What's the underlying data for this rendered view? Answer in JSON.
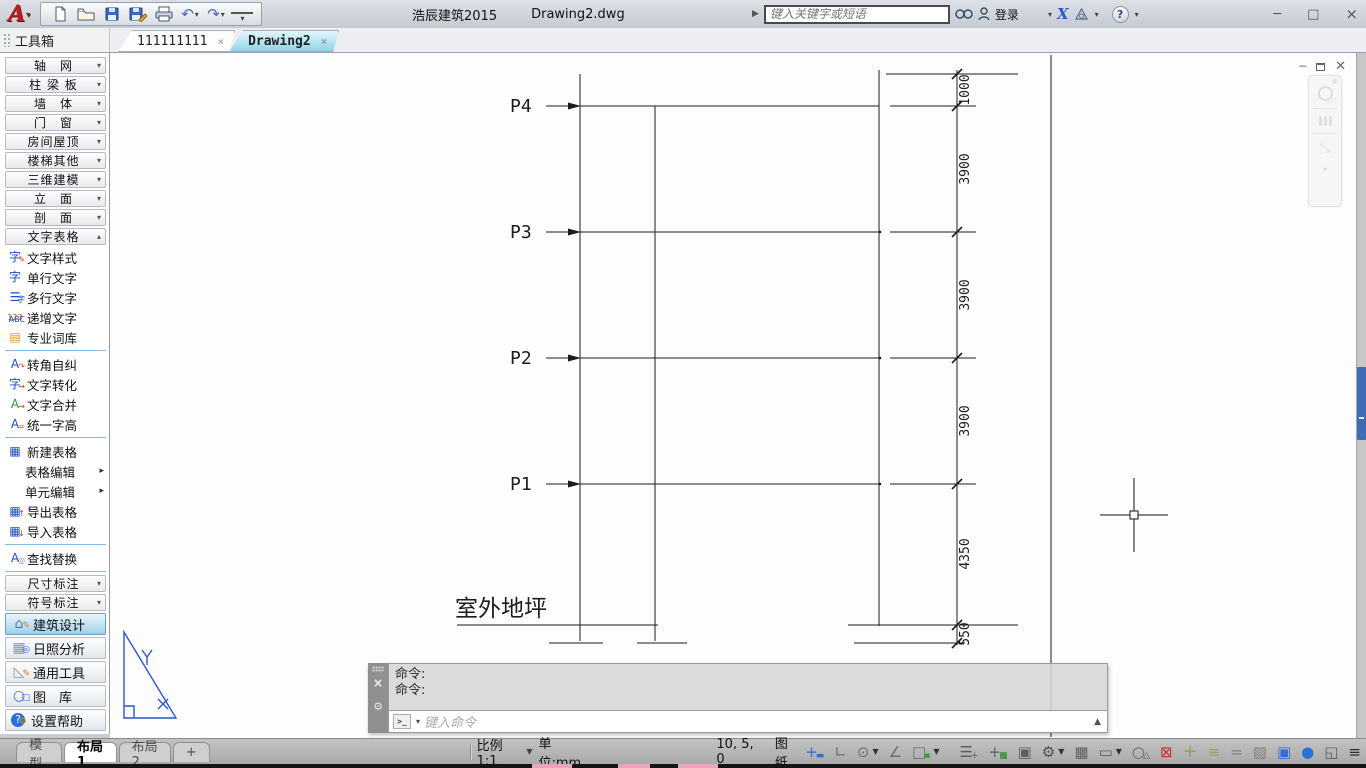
{
  "window": {
    "app_title": "浩辰建筑2015",
    "doc_title": "Drawing2.dwg",
    "controls": {
      "minimize": "─",
      "maximize": "□",
      "close": "×"
    }
  },
  "qat": {
    "undo_glyph": "↶",
    "redo_glyph": "↷",
    "customize_glyph": "▾"
  },
  "search": {
    "placeholder": "键入关键字或短语",
    "login_label": "登录",
    "x_glyph": "X",
    "help_glyph": "?"
  },
  "doc_tabs": {
    "toolbox_header": "工具箱",
    "tabs": [
      {
        "label": "111111111",
        "active": false,
        "close": "×"
      },
      {
        "label": "Drawing2",
        "active": true,
        "close": "×"
      }
    ]
  },
  "toolbox": {
    "groups_top": [
      "轴　网",
      "柱 梁 板",
      "墙　体",
      "门　窗",
      "房间屋顶",
      "楼梯其他",
      "三维建模",
      "立　面",
      "剖　面"
    ],
    "group_expanded": "文字表格",
    "items": [
      {
        "label": "文字样式",
        "icon": "text-style-icon",
        "glyph": "字",
        "accent": "✎",
        "color": "#1d4fc0",
        "accent_color": "#d43a00"
      },
      {
        "label": "单行文字",
        "icon": "single-line-text-icon",
        "glyph": "字",
        "color": "#1d4fc0"
      },
      {
        "label": "多行文字",
        "icon": "multi-line-text-icon",
        "glyph": "☰",
        "accent": "字",
        "color": "#1d4fc0",
        "accent_color": "#1d4fc0"
      },
      {
        "label": "递增文字",
        "icon": "increment-text-icon",
        "glyph": "123",
        "accent": "ABC",
        "color": "#d43a00",
        "accent_color": "#1d4fc0",
        "small": true
      },
      {
        "label": "专业词库",
        "icon": "dictionary-icon",
        "glyph": "▤",
        "color": "#d49a20",
        "divider_after": true
      },
      {
        "label": "转角自纠",
        "icon": "corner-correct-icon",
        "glyph": "A",
        "accent": "↷",
        "color": "#1d4fc0",
        "accent_color": "#d43a00"
      },
      {
        "label": "文字转化",
        "icon": "text-convert-icon",
        "glyph": "字",
        "accent": "→",
        "color": "#1d4fc0",
        "accent_color": "#d43a00"
      },
      {
        "label": "文字合并",
        "icon": "text-merge-icon",
        "glyph": "A",
        "accent": "→",
        "color": "#2a9a3a",
        "accent_color": "#d43a00"
      },
      {
        "label": "统一字高",
        "icon": "unify-height-icon",
        "glyph": "A",
        "accent": "=",
        "color": "#1d4fc0",
        "accent_color": "#d43a00",
        "divider_after": true
      },
      {
        "label": "新建表格",
        "icon": "new-table-icon",
        "glyph": "▦",
        "color": "#1d4fc0"
      },
      {
        "label": "表格编辑",
        "icon": "none",
        "submenu": true,
        "indent": true
      },
      {
        "label": "单元编辑",
        "icon": "none",
        "submenu": true,
        "indent": true
      },
      {
        "label": "导出表格",
        "icon": "export-table-icon",
        "glyph": "▦",
        "accent": "↑",
        "color": "#1d4fc0",
        "accent_color": "#d43a00"
      },
      {
        "label": "导入表格",
        "icon": "import-table-icon",
        "glyph": "▦",
        "accent": "↓",
        "color": "#1d4fc0",
        "accent_color": "#d43a00",
        "divider_after": true
      },
      {
        "label": "查找替换",
        "icon": "find-replace-icon",
        "glyph": "A",
        "accent": "◎",
        "color": "#1d4fc0",
        "accent_color": "#7a8aa0"
      }
    ],
    "groups_bottom": [
      "尺寸标注",
      "符号标注"
    ],
    "modes": [
      {
        "label": "建筑设计",
        "icon": "building-design-icon",
        "glyph": "⌂",
        "accent": "✎",
        "color": "#5b78a8",
        "accent_color": "#e07818",
        "selected": true
      },
      {
        "label": "日照分析",
        "icon": "sunlight-analysis-icon",
        "glyph": "▦",
        "accent": "◎",
        "color": "#8a97b0",
        "accent_color": "#3a6ad0",
        "selected": false
      },
      {
        "label": "通用工具",
        "icon": "general-tools-icon",
        "glyph": "◺",
        "accent": "✎",
        "color": "#8a97b0",
        "accent_color": "#e07818",
        "selected": false
      },
      {
        "label": "图　库",
        "icon": "library-icon",
        "glyph": "○",
        "accent": "□",
        "color": "#3a6ad0",
        "accent_color": "#3a6ad0",
        "selected": false
      },
      {
        "label": "设置帮助",
        "icon": "settings-help-icon",
        "glyph": "?",
        "accent": "⚙",
        "color": "#ffffff",
        "accent_color": "#c89018",
        "qcircle": true,
        "selected": false
      }
    ]
  },
  "drawing": {
    "levels": [
      {
        "name": "P4"
      },
      {
        "name": "P3"
      },
      {
        "name": "P2"
      },
      {
        "name": "P1"
      }
    ],
    "dims": [
      "1000",
      "3900",
      "3900",
      "3900",
      "4350",
      "550"
    ],
    "ground_label": "室外地坪",
    "line_color": "#1c1c1c",
    "triangle_color": "#2f55cf"
  },
  "command": {
    "history": [
      "命令:",
      "命令:"
    ],
    "placeholder": "键入命令",
    "prompt_icon": ">_"
  },
  "status": {
    "layout_tabs": [
      {
        "label": "模型",
        "active": false
      },
      {
        "label": "布局1",
        "active": true
      },
      {
        "label": "布局2",
        "active": false
      },
      {
        "label": "+",
        "active": false
      }
    ],
    "scale_label": "比例 1:1",
    "units_label": "单位:mm",
    "coords": "10, 5, 0",
    "space_label": "图纸",
    "left_icons": [
      {
        "name": "snap-icon",
        "glyph": "+",
        "accent": "▬",
        "color": "#2a6fd6",
        "accent_color": "#2a6fd6"
      },
      {
        "name": "ortho-icon",
        "glyph": "∟",
        "color": "#6e6e6e"
      },
      {
        "name": "polar-tracking-icon",
        "glyph": "⊙",
        "color": "#6e6e6e",
        "dropdown": true
      },
      {
        "name": "osnap-icon",
        "glyph": "∠",
        "color": "#6e6e6e"
      },
      {
        "name": "otrack-icon",
        "glyph": "□",
        "accent": "▪",
        "color": "#6e6e6e",
        "accent_color": "#3aa03a",
        "dropdown": true
      }
    ],
    "right_icons": [
      {
        "name": "dynamic-input-icon",
        "glyph": "☰",
        "accent": "+",
        "color": "#5e5e5e",
        "accent_color": "#5e5e5e"
      },
      {
        "name": "object-snap-plus-icon",
        "glyph": "+",
        "accent": "■",
        "color": "#5e5e5e",
        "accent_color": "#4a9a4a"
      },
      {
        "name": "selection-cycling-icon",
        "glyph": "▣",
        "color": "#5e5e5e"
      },
      {
        "name": "gear-icon",
        "glyph": "⚙",
        "color": "#4e4e4e",
        "dropdown": true
      },
      {
        "name": "quick-properties-icon",
        "glyph": "▦",
        "color": "#5e5e5e"
      },
      {
        "name": "lock-ui-icon",
        "glyph": "▭",
        "color": "#5e5e5e",
        "dropdown": true
      },
      {
        "name": "isolate-objects-icon",
        "glyph": "○",
        "accent": "△",
        "color": "#5e5e5e",
        "accent_color": "#5e5e5e"
      },
      {
        "name": "clean-screen-icon",
        "glyph": "⊠",
        "color": "#c03030"
      },
      {
        "name": "crosshair-size-icon",
        "glyph": "+",
        "color": "#98a05e",
        "big": true
      },
      {
        "name": "lineweight-icon",
        "glyph": "≡",
        "color": "#98a05e"
      },
      {
        "name": "transparency-icon",
        "glyph": "=",
        "color": "#808080"
      },
      {
        "name": "hatch-icon",
        "glyph": "▨",
        "color": "#808080"
      },
      {
        "name": "layers-icon",
        "glyph": "▣",
        "color": "#2a6fd6"
      },
      {
        "name": "annotation-icon",
        "glyph": "●",
        "color": "#2a6fd6"
      },
      {
        "name": "app-window-icon",
        "glyph": "◱",
        "color": "#5e5e5e"
      },
      {
        "name": "statusbar-menu-icon",
        "glyph": "≡",
        "color": "#2e2e2e"
      }
    ]
  }
}
